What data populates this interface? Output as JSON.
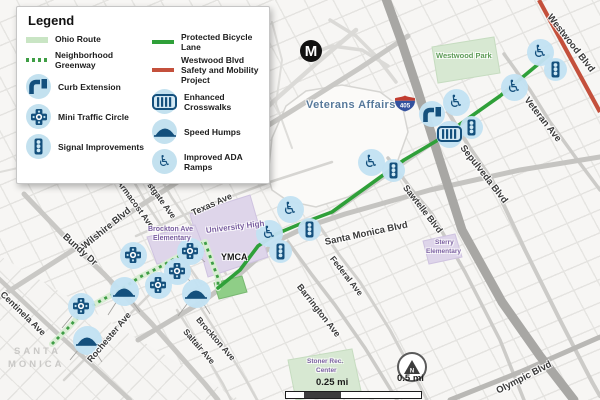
{
  "colors": {
    "navy": "#14507d",
    "marker_circle": "#c3e1ef",
    "bike_green": "#2fa039",
    "greenway_green": "#3f9e45",
    "ohio_green": "#c9e5c4",
    "project_red": "#c4503c",
    "lavender": "#ded5ea",
    "park_green": "#d7e8d2",
    "school_text": "#7a5fa0",
    "park_text": "#5d9b57",
    "va_text": "#57799b"
  },
  "legend": {
    "title": "Legend",
    "columns": [
      [
        {
          "type": "swatch",
          "swatch": "ohio",
          "label": "Ohio Route"
        },
        {
          "type": "swatch",
          "swatch": "greenway",
          "label": "Neighborhood Greenway"
        },
        {
          "type": "icon",
          "icon": "curb",
          "label": "Curb Extension"
        },
        {
          "type": "icon",
          "icon": "circle",
          "label": "Mini Traffic Circle"
        },
        {
          "type": "icon",
          "icon": "signal",
          "label": "Signal Improvements"
        }
      ],
      [
        {
          "type": "swatch",
          "swatch": "bikelane",
          "label": "Protected Bicycle Lane"
        },
        {
          "type": "swatch",
          "swatch": "westwood",
          "label": "Westwood Blvd Safety and Mobility Project"
        },
        {
          "type": "icon",
          "icon": "xwalk",
          "label": "Enhanced Crosswalks"
        },
        {
          "type": "icon",
          "icon": "hump",
          "label": "Speed Humps"
        },
        {
          "type": "icon",
          "icon": "ada",
          "label": "Improved ADA Ramps"
        }
      ]
    ]
  },
  "badges": {
    "metro": {
      "label": "M"
    },
    "shield": {
      "label": "405"
    },
    "north": {
      "label": "N"
    },
    "scalebar": {
      "quarter_label": "0.25 mi",
      "half_label": "0.5 mi"
    }
  },
  "map": {
    "areas": [
      {
        "name": "veterans-affairs-campus",
        "pts": "268,176 272,138 286,106 306,91 342,85 380,92 403,109 408,132 398,160 378,180 348,197 316,207 288,201 272,190",
        "fill": "#fbfaf8",
        "stroke": "#d6d5d2"
      },
      {
        "name": "westwood-park",
        "pts": "432,47 494,37 500,73 438,83",
        "fill": "#d7e8d2",
        "stroke": "#c6dcc0"
      },
      {
        "name": "university-high",
        "pts": "190,214 250,195 268,257 208,277",
        "fill": "#ded5ea",
        "stroke": "#cfc3e0"
      },
      {
        "name": "brockton-ave-elementary",
        "pts": "147,237 195,225 205,251 157,264",
        "fill": "#ded5ea",
        "stroke": "#cfc3e0"
      },
      {
        "name": "sterry-elementary",
        "pts": "423,241 455,234 462,257 429,264",
        "fill": "#ded5ea",
        "stroke": "#cfc3e0"
      },
      {
        "name": "stoner-rec-center",
        "pts": "288,360 352,349 361,391 296,400",
        "fill": "#d7e8d2",
        "stroke": "#c6dcc0"
      },
      {
        "name": "small-park-block",
        "pts": "214,283 242,276 247,292 219,299",
        "fill": "#8fce87",
        "stroke": "#79b872"
      }
    ],
    "roads": [
      {
        "name": "curvy-road-1",
        "pts": "0,172 40,163 70,172 96,166",
        "w": 2,
        "c": "#dedddA"
      },
      {
        "name": "curvy-road-2",
        "pts": "272,22 282,60 276,104 292,148",
        "w": 2,
        "c": "#dedddA"
      },
      {
        "name": "westgate-ave",
        "pts": "150,160 172,198 196,232 226,274",
        "w": 2.5,
        "c": "#d6d5d2"
      },
      {
        "name": "armacost-ave",
        "pts": "126,168 148,206 172,242 201,284",
        "w": 2.5,
        "c": "#d6d5d2"
      },
      {
        "name": "brockton-ave",
        "pts": "196,300 220,338 246,380 257,400",
        "w": 2.5,
        "c": "#d6d5d2"
      },
      {
        "name": "saltair-ave",
        "pts": "177,310 200,346 223,384 231,400",
        "w": 2.5,
        "c": "#d6d5d2"
      },
      {
        "name": "rochester-ave",
        "pts": "64,380 110,334 154,290",
        "w": 2.5,
        "c": "#d6d5d2"
      },
      {
        "name": "texas-ave",
        "pts": "136,236 200,208 270,182 332,162",
        "w": 2.5,
        "c": "#d6d5d2"
      },
      {
        "name": "federal-ave",
        "pts": "318,224 340,256 360,282 390,330 420,386 427,400",
        "w": 3,
        "c": "#d2d1ce"
      },
      {
        "name": "ohio-ave",
        "pts": "332,214 380,180 438,140 500,96 549,55",
        "w": 3,
        "c": "#cfcecb"
      },
      {
        "name": "san-vicente",
        "pts": "228,144 275,100 318,62 356,30",
        "w": 4.5,
        "c": "#dbdad7"
      },
      {
        "name": "ramp-1",
        "pts": "300,58 332,46 362,50 388,66",
        "w": 3.5,
        "c": "#dbdad7"
      },
      {
        "name": "ramp-2",
        "pts": "330,20 356,36 376,56 396,82",
        "w": 3.5,
        "c": "#dbdad7"
      },
      {
        "name": "sepulveda-blvd",
        "pts": "448,112 470,148 492,180 525,250 560,320 592,382 600,396",
        "w": 4,
        "c": "#cccbc8"
      },
      {
        "name": "sawtelle-blvd",
        "pts": "388,158 412,190 432,214 465,272 500,340 524,400",
        "w": 3.5,
        "c": "#cccbc8"
      },
      {
        "name": "veteran-ave",
        "pts": "504,54 530,90 550,122 576,158 600,190",
        "w": 3.5,
        "c": "#cccbc8"
      },
      {
        "name": "barrington-ave",
        "pts": "288,242 312,275 335,305 365,348 397,400",
        "w": 3.5,
        "c": "#cccbc8"
      },
      {
        "name": "wilshire-blvd",
        "pts": "-5,300 70,252 140,206 215,158 290,112 360,68 408,36",
        "w": 5,
        "c": "#c9c8c5"
      },
      {
        "name": "bundy-dr",
        "pts": "24,194 66,238 104,274 152,324 205,384 218,400",
        "w": 5,
        "c": "#c9c8c5"
      },
      {
        "name": "centinela-ave",
        "pts": "-4,276 45,322 92,365 130,400",
        "w": 4.5,
        "c": "#c9c8c5"
      },
      {
        "name": "santa-monica-blvd",
        "pts": "138,340 205,300 242,272 277,241 306,227 345,214 430,190 520,170 600,157",
        "w": 5,
        "c": "#c5c4c1"
      },
      {
        "name": "olympic-blvd",
        "pts": "450,400 520,372 600,337",
        "w": 5,
        "c": "#b9b8b5"
      },
      {
        "name": "i405-freeway",
        "pts": "385,-4 401,40 417,88 439,158 462,230 502,302 540,356 574,400",
        "w": 9,
        "c": "#a8a7a4"
      }
    ],
    "callouts": [
      "124,290 108,315",
      "124,290 140,312",
      "196,292 178,316",
      "196,292 210,314",
      "87,339 70,360",
      "87,339 102,362",
      "81,305 62,328",
      "190,250 205,262",
      "177,269 190,281"
    ],
    "routes": {
      "greenway": [
        "52,344 70,326 84,310 102,300 120,290 140,277 158,268 176,258 192,249 205,242",
        "205,242 212,262 218,278 218,288"
      ],
      "protected": "218,288 240,270 258,246 276,234 300,224 332,212 368,186 404,160 438,140 466,120 500,96 530,71 548,56",
      "westwood": "539,0 600,112"
    },
    "markers": [
      {
        "t": "ada",
        "x": 540,
        "y": 52
      },
      {
        "t": "signal",
        "x": 555,
        "y": 69
      },
      {
        "t": "ada",
        "x": 514,
        "y": 87
      },
      {
        "t": "curb",
        "x": 432,
        "y": 114
      },
      {
        "t": "ada",
        "x": 456,
        "y": 102
      },
      {
        "t": "signal",
        "x": 471,
        "y": 127
      },
      {
        "t": "xwalk",
        "x": 449,
        "y": 134
      },
      {
        "t": "ada",
        "x": 371,
        "y": 162
      },
      {
        "t": "signal",
        "x": 393,
        "y": 170
      },
      {
        "t": "ada",
        "x": 290,
        "y": 209
      },
      {
        "t": "signal",
        "x": 309,
        "y": 229
      },
      {
        "t": "ada",
        "x": 269,
        "y": 233
      },
      {
        "t": "signal",
        "x": 280,
        "y": 251
      },
      {
        "t": "circle",
        "x": 133,
        "y": 255
      },
      {
        "t": "circle",
        "x": 190,
        "y": 251
      },
      {
        "t": "circle",
        "x": 177,
        "y": 271
      },
      {
        "t": "circle",
        "x": 158,
        "y": 285
      },
      {
        "t": "circle",
        "x": 81,
        "y": 306
      },
      {
        "t": "hump",
        "x": 124,
        "y": 291
      },
      {
        "t": "hump",
        "x": 196,
        "y": 293
      },
      {
        "t": "hump",
        "x": 87,
        "y": 340
      }
    ],
    "street_labels": [
      {
        "text": "Westwood Blvd",
        "x": 549,
        "y": 16,
        "rot": 52,
        "size": 9.5
      },
      {
        "text": "Veteran Ave",
        "x": 526,
        "y": 99,
        "rot": 52,
        "size": 9.5
      },
      {
        "text": "Sepulveda Blvd",
        "x": 462,
        "y": 147,
        "rot": 52,
        "size": 9.5
      },
      {
        "text": "Sawtelle Blvd",
        "x": 405,
        "y": 187,
        "rot": 52,
        "size": 9
      },
      {
        "text": "Santa Monica Blvd",
        "x": 325,
        "y": 243,
        "rot": -12,
        "size": 9.5
      },
      {
        "text": "Federal Ave",
        "x": 332,
        "y": 258,
        "rot": 52,
        "size": 8.5
      },
      {
        "text": "Barrington Ave",
        "x": 299,
        "y": 286,
        "rot": 52,
        "size": 9
      },
      {
        "text": "Olympic Blvd",
        "x": 497,
        "y": 392,
        "rot": -27,
        "size": 9.5
      },
      {
        "text": "Texas Ave",
        "x": 192,
        "y": 214,
        "rot": -24,
        "size": 9
      },
      {
        "text": "Westgate Ave",
        "x": 142,
        "y": 174,
        "rot": 54,
        "size": 8.5
      },
      {
        "text": "Armacost Ave",
        "x": 119,
        "y": 182,
        "rot": 54,
        "size": 8.5
      },
      {
        "text": "Wilshire Blvd",
        "x": 83,
        "y": 248,
        "rot": -39,
        "size": 9.5
      },
      {
        "text": "Bundy Dr",
        "x": 64,
        "y": 236,
        "rot": 42,
        "size": 9.5
      },
      {
        "text": "Centinela Ave",
        "x": 2,
        "y": 294,
        "rot": 44,
        "size": 9
      },
      {
        "text": "Rochester Ave",
        "x": 89,
        "y": 362,
        "rot": -50,
        "size": 9
      },
      {
        "text": "Brockton Ave",
        "x": 198,
        "y": 319,
        "rot": 49,
        "size": 8.5
      },
      {
        "text": "Saltair Ave",
        "x": 185,
        "y": 331,
        "rot": 49,
        "size": 8.5
      }
    ],
    "area_labels": [
      {
        "text": "Veterans Affairs",
        "x": 306,
        "y": 105,
        "cls": "va",
        "size": 11,
        "rot": 0
      },
      {
        "text": "Westwood Park",
        "x": 436,
        "y": 57,
        "cls": "park",
        "size": 7.5,
        "rot": 0
      },
      {
        "text": "University High",
        "x": 206,
        "y": 232,
        "cls": "school",
        "size": 8,
        "rot": -7
      },
      {
        "text": "Brockton Ave",
        "x": 148,
        "y": 232,
        "cls": "school",
        "size": 7,
        "rot": 0
      },
      {
        "text": "Elementary",
        "x": 153,
        "y": 241,
        "cls": "school",
        "size": 7,
        "rot": 0
      },
      {
        "text": "YMCA",
        "x": 221,
        "y": 258,
        "cls": "poi",
        "size": 9,
        "rot": 0
      },
      {
        "text": "Sterry",
        "x": 435,
        "y": 245,
        "cls": "school",
        "size": 6.5,
        "rot": 0
      },
      {
        "text": "Elementary",
        "x": 426,
        "y": 254,
        "cls": "school",
        "size": 6.5,
        "rot": 0
      },
      {
        "text": "Stoner Rec.",
        "x": 307,
        "y": 364,
        "cls": "school",
        "size": 6.5,
        "rot": 0
      },
      {
        "text": "Center",
        "x": 316,
        "y": 373,
        "cls": "school",
        "size": 6.5,
        "rot": 0
      },
      {
        "text": "SANTA",
        "x": 14,
        "y": 352,
        "cls": "city",
        "size": 9.5,
        "rot": 0
      },
      {
        "text": "MONICA",
        "x": 8,
        "y": 365,
        "cls": "city",
        "size": 9.5,
        "rot": 0
      }
    ]
  }
}
